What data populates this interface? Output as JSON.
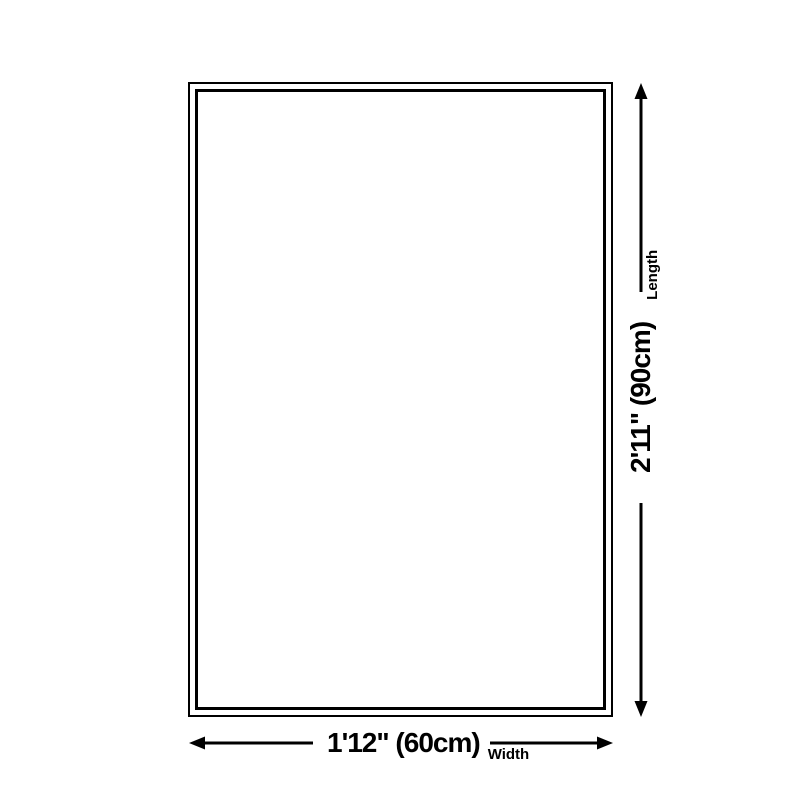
{
  "diagram": {
    "type": "product-size-diagram",
    "colors": {
      "background": "#ffffff",
      "line": "#000000",
      "text": "#000000"
    },
    "length_dimension": {
      "value": "2'11\" (90cm)",
      "label": "Length"
    },
    "width_dimension": {
      "value": "1'12\" (60cm)",
      "label": "Width"
    }
  }
}
